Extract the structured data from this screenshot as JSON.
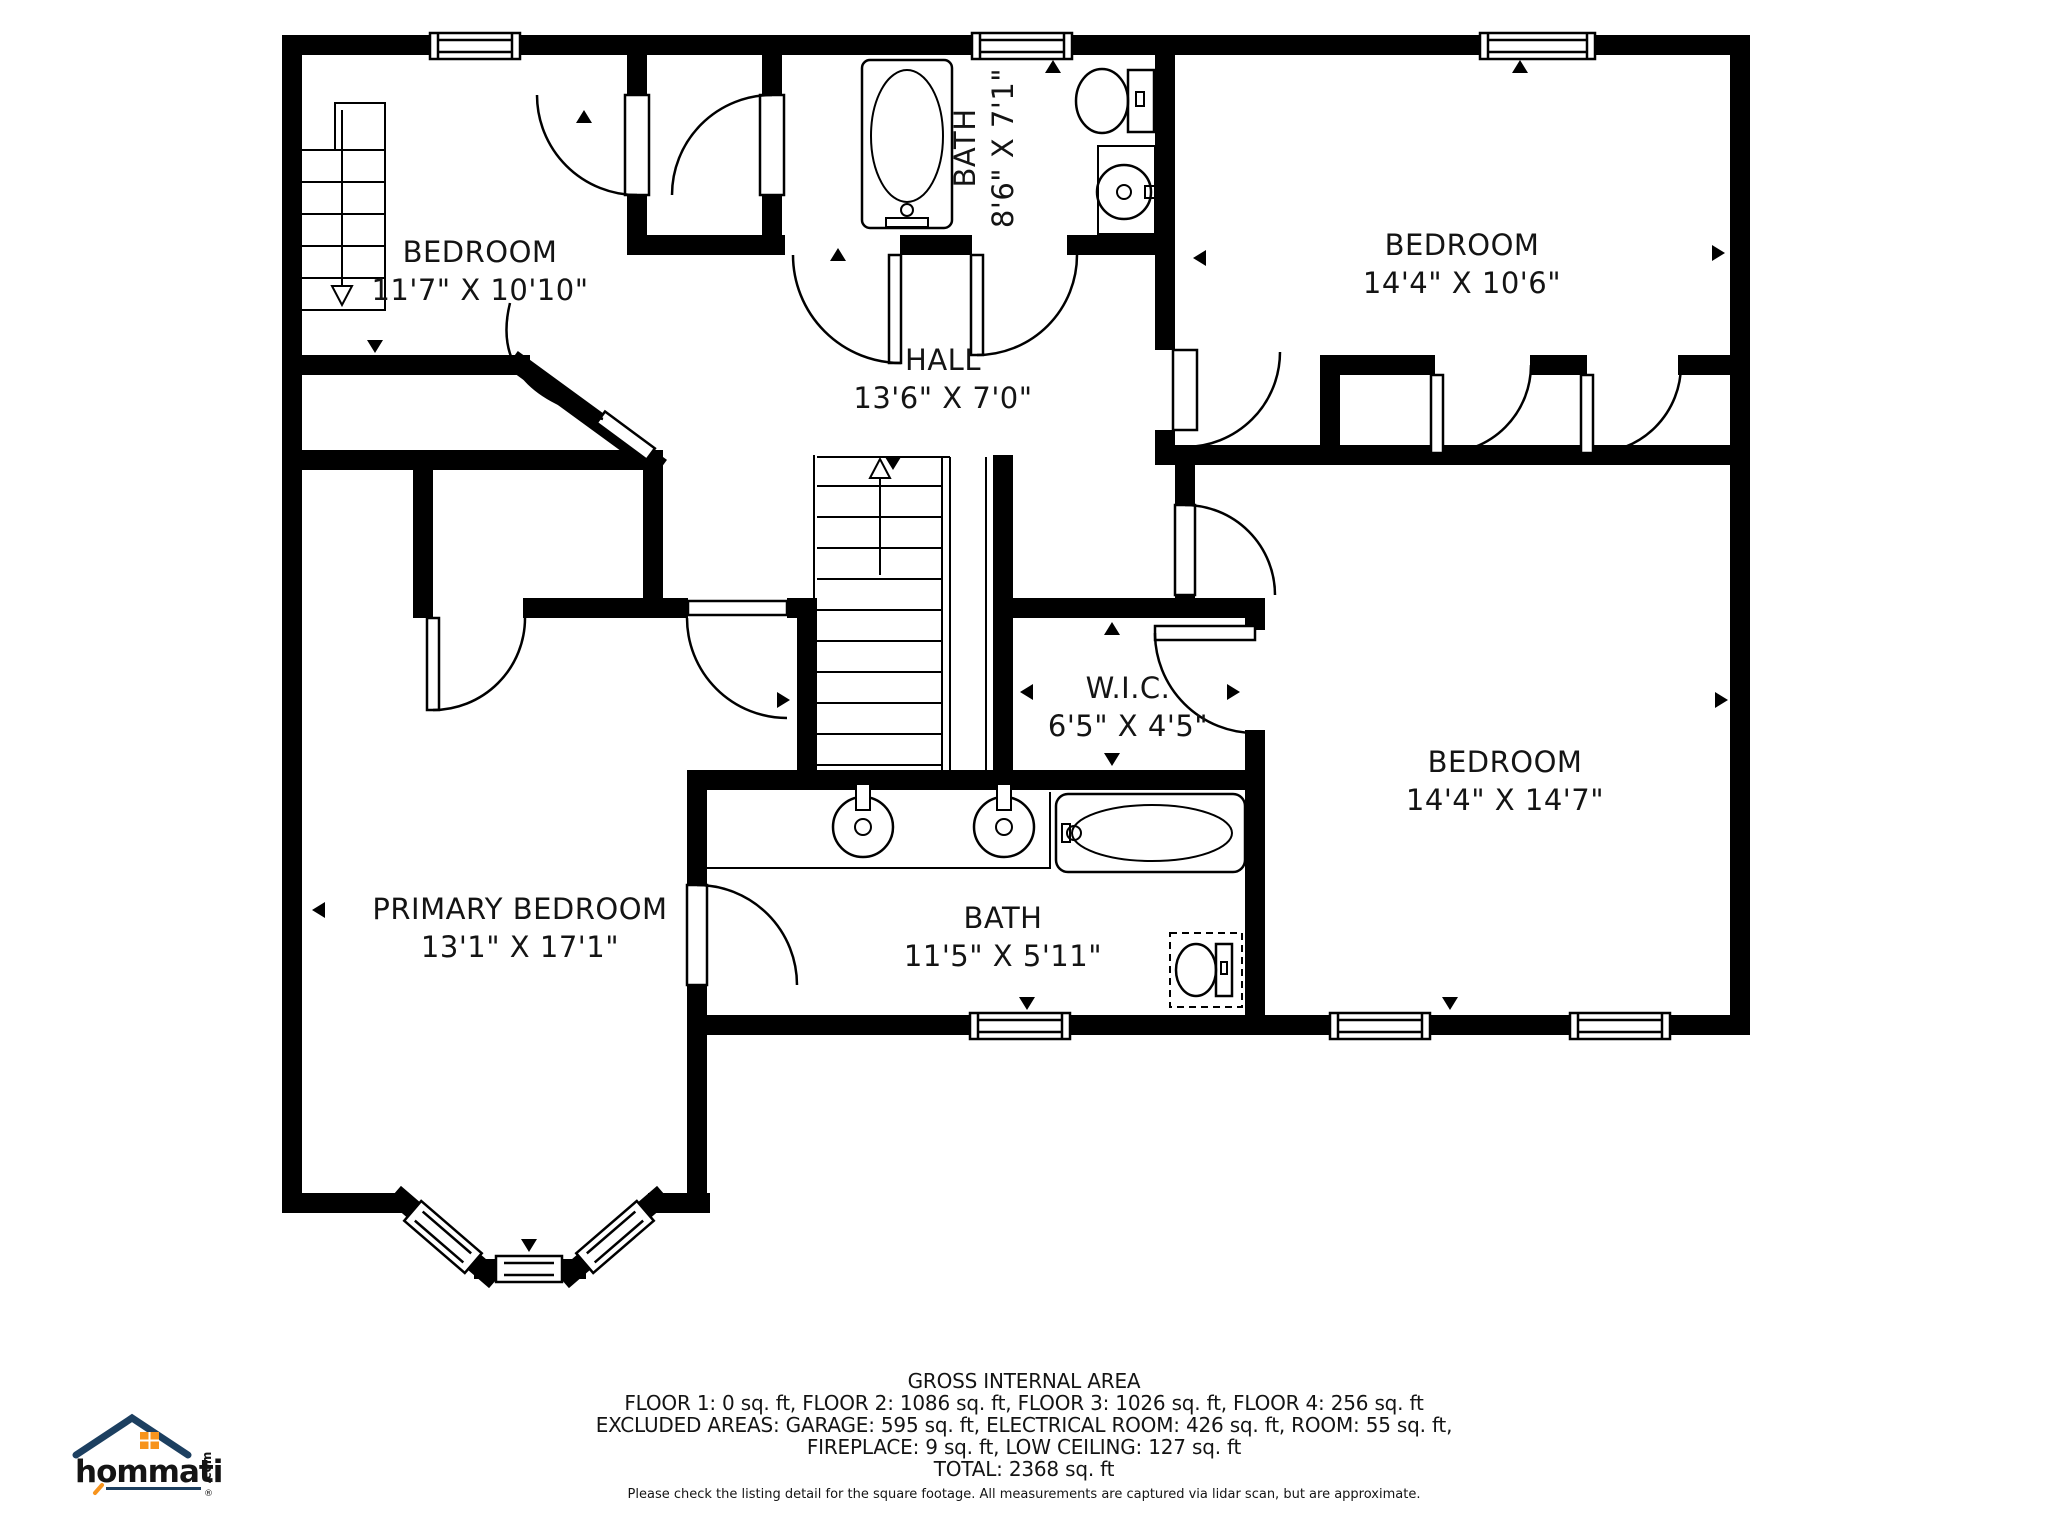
{
  "meta": {
    "wall_color": "#000000",
    "background": "#ffffff",
    "label_color": "#141414"
  },
  "rooms": [
    {
      "id": "bedroom-top-left",
      "name": "BEDROOM",
      "dims": "11'7\" X 10'10\""
    },
    {
      "id": "bath-top",
      "name": "BATH",
      "dims": "8'6\" X 7'1\""
    },
    {
      "id": "bedroom-top-right",
      "name": "BEDROOM",
      "dims": "14'4\" X 10'6\""
    },
    {
      "id": "hall",
      "name": "HALL",
      "dims": "13'6\" X 7'0\""
    },
    {
      "id": "wic",
      "name": "W.I.C.",
      "dims": "6'5\" X 4'5\""
    },
    {
      "id": "bedroom-right",
      "name": "BEDROOM",
      "dims": "14'4\" X 14'7\""
    },
    {
      "id": "primary-bedroom",
      "name": "PRIMARY BEDROOM",
      "dims": "13'1\" X 17'1\""
    },
    {
      "id": "bath-bottom",
      "name": "BATH",
      "dims": "11'5\" X 5'11\""
    }
  ],
  "footer": {
    "title": "GROSS INTERNAL AREA",
    "line1": "FLOOR 1: 0 sq. ft, FLOOR 2: 1086 sq. ft, FLOOR 3: 1026 sq. ft, FLOOR 4: 256 sq. ft",
    "line2": "EXCLUDED AREAS: GARAGE: 595 sq. ft, ELECTRICAL ROOM: 426 sq. ft, ROOM: 55 sq. ft,",
    "line3": "FIREPLACE: 9 sq. ft, LOW CEILING: 127 sq. ft",
    "line4": "TOTAL: 2368 sq. ft",
    "disclaimer": "Please check the listing detail for the square footage. All measurements are captured via lidar scan, but are approximate."
  },
  "logo": {
    "brand": "hommati",
    "tld": ".com",
    "registered": "®",
    "navy": "#1c3f60",
    "orange": "#f7941d"
  }
}
